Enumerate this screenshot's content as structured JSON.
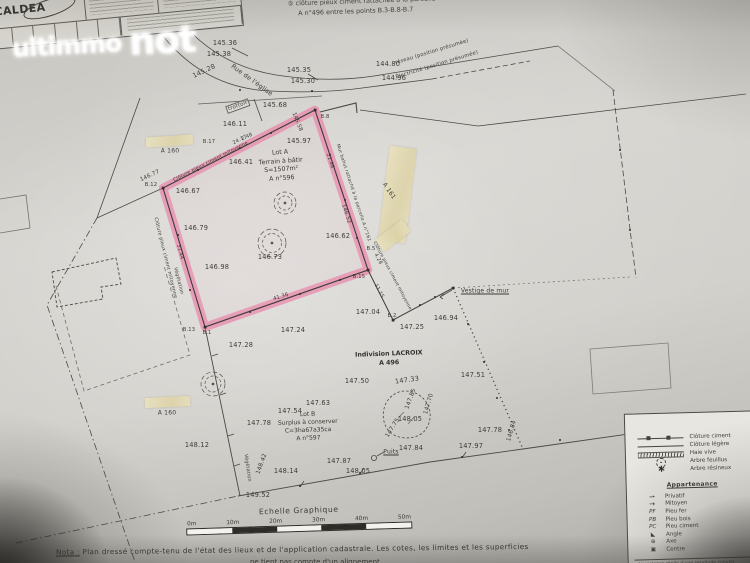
{
  "watermark": {
    "part1": "ultimmo",
    "part2": "not"
  },
  "title_block": {
    "logo": "CALDEA"
  },
  "top_note": {
    "line1": "⑤ clôture pieux ciment rattachée à la parcelle",
    "line2": "A n°496 entre les points B.3-B.8-B.7"
  },
  "lot_a": {
    "l1": "Lot A",
    "l2": "Terrain à bâtir",
    "l3": "S=1507m²",
    "l4": "A n°596"
  },
  "lot_b": {
    "l1": "Lot B",
    "l2": "Surplus à conserver",
    "l3": "C=3ha67a35ca",
    "l4": "A n°597"
  },
  "indivision": {
    "l1": "Indivision LACROIX",
    "l2": "A 496"
  },
  "scale": {
    "title": "Echelle Graphique",
    "ticks": [
      "0m",
      "10m",
      "20m",
      "30m",
      "40m",
      "50m"
    ]
  },
  "nota": {
    "prefix": "Nota :",
    "line1": "Plan dressé compte-tenu de l'état des lieux et de l'application cadastrale. Les cotes, les limites et les superficies",
    "line2": "ne tient pas compte d'un alignement"
  },
  "legend": {
    "heading": "Appartenance",
    "rows": [
      {
        "symbol": "cloture-ciment",
        "label": "Clôture ciment"
      },
      {
        "symbol": "cloture-legere",
        "label": "Clôture légère"
      },
      {
        "symbol": "haie-vive",
        "label": "Haie vive"
      },
      {
        "symbol": "arbre-feuillus",
        "label": "Arbre feuillus"
      },
      {
        "symbol": "arbre-resineux",
        "label": "Arbre résineux"
      }
    ],
    "appartenance": [
      {
        "abbr": "⇀",
        "arrow": true,
        "label": "Privatif"
      },
      {
        "abbr": "→",
        "arrow": true,
        "label": "Mitoyen"
      },
      {
        "abbr": "PF",
        "label": "Pieu fer"
      },
      {
        "abbr": "PB",
        "label": "Pieu bois"
      },
      {
        "abbr": "PC",
        "label": "Pieu ciment"
      },
      {
        "abbr": "◣",
        "label": "Angle"
      },
      {
        "abbr": "⊕",
        "label": "Axe"
      },
      {
        "abbr": "▣",
        "label": "Centre"
      }
    ],
    "footer": "L'existence réelle d'une servitude conven"
  },
  "accent_colors": {
    "highlight_pink": "#ee6b9d",
    "tape_beige": "#e3dab2",
    "line_gray": "#4b4944"
  },
  "map_labels": [
    {
      "t": "145.36",
      "x": 225,
      "y": 43
    },
    {
      "t": "145.38",
      "x": 219,
      "y": 54
    },
    {
      "t": "145.28",
      "x": 204,
      "y": 71,
      "r": -25
    },
    {
      "t": "145.35",
      "x": 299,
      "y": 70
    },
    {
      "t": "145.30",
      "x": 303,
      "y": 81
    },
    {
      "t": "144.80",
      "x": 388,
      "y": 64
    },
    {
      "t": "144.96",
      "x": 394,
      "y": 78
    },
    {
      "t": "réseau (position présumée)",
      "x": 432,
      "y": 52,
      "r": -17,
      "s": 5.2,
      "n": "utility-note"
    },
    {
      "t": "Électricité (position présumée)",
      "x": 437,
      "y": 65,
      "r": -17,
      "s": 5.2,
      "n": "utility-note"
    },
    {
      "t": "trottoir",
      "x": 238,
      "y": 106,
      "r": -20,
      "s": 5.4,
      "cls": "boxed",
      "n": "sidewalk-label"
    },
    {
      "t": "Rue de l'église",
      "x": 252,
      "y": 80,
      "r": 36,
      "s": 6.4,
      "n": "street-name"
    },
    {
      "t": "145.68",
      "x": 275,
      "y": 105
    },
    {
      "t": "145.58",
      "x": 297,
      "y": 122,
      "r": 68,
      "s": 5.4
    },
    {
      "t": "2.48",
      "x": 247,
      "y": 137,
      "r": -25,
      "s": 5
    },
    {
      "t": "B.17",
      "x": 209,
      "y": 142,
      "s": 5.2,
      "n": "boundary-point"
    },
    {
      "t": "146.11",
      "x": 235,
      "y": 124
    },
    {
      "t": "146.41",
      "x": 241,
      "y": 162
    },
    {
      "t": "145.97",
      "x": 299,
      "y": 141
    },
    {
      "t": "Clôture pieux ciment mitoyenne",
      "x": 211,
      "y": 162,
      "r": -27,
      "s": 4.8,
      "n": "fence-note"
    },
    {
      "t": "24.17",
      "x": 240,
      "y": 140,
      "r": -27,
      "s": 5,
      "n": "dimension"
    },
    {
      "t": "B.12",
      "x": 151,
      "y": 185,
      "s": 5.2,
      "n": "boundary-point"
    },
    {
      "t": "146.77",
      "x": 150,
      "y": 176,
      "r": -25,
      "s": 5.6
    },
    {
      "t": "146.67",
      "x": 188,
      "y": 191
    },
    {
      "t": "Clôture pieux ciment mitoyenne",
      "x": 165,
      "y": 258,
      "r": 76,
      "s": 4.8,
      "n": "fence-note"
    },
    {
      "t": "31.44",
      "x": 180,
      "y": 252,
      "r": 76,
      "s": 5,
      "n": "dimension"
    },
    {
      "t": "146.79",
      "x": 196,
      "y": 228
    },
    {
      "t": "146.98",
      "x": 217,
      "y": 267
    },
    {
      "t": "146.73",
      "x": 270,
      "y": 257
    },
    {
      "t": "146.62",
      "x": 338,
      "y": 236
    },
    {
      "t": "146.52",
      "x": 346,
      "y": 214,
      "r": 72,
      "s": 5.4
    },
    {
      "t": "21.48",
      "x": 330,
      "y": 161,
      "r": 72,
      "s": 5,
      "n": "dimension"
    },
    {
      "t": "Mur bahut rattaché à la parcelle A n°161",
      "x": 353,
      "y": 193,
      "r": 72,
      "s": 4.6,
      "n": "wall-note"
    },
    {
      "t": "A 161",
      "x": 389,
      "y": 191,
      "r": 56,
      "s": 6,
      "n": "parcel-label"
    },
    {
      "t": "B.8",
      "x": 325,
      "y": 117,
      "s": 5.2,
      "n": "boundary-point"
    },
    {
      "t": "B.5",
      "x": 371,
      "y": 249,
      "s": 5.2,
      "n": "boundary-point"
    },
    {
      "t": "4.28",
      "x": 378,
      "y": 259,
      "r": 62,
      "s": 5,
      "n": "dimension"
    },
    {
      "t": "B.15",
      "x": 359,
      "y": 277,
      "s": 5.2,
      "n": "boundary-point"
    },
    {
      "t": "11.15",
      "x": 379,
      "y": 291,
      "r": 62,
      "s": 5,
      "n": "dimension"
    },
    {
      "t": "Clôture pieux ciment mitoyenne",
      "x": 392,
      "y": 276,
      "r": 62,
      "s": 4.4,
      "n": "fence-note"
    },
    {
      "t": "B.2",
      "x": 392,
      "y": 316,
      "s": 5.2,
      "n": "boundary-point"
    },
    {
      "t": "41.36",
      "x": 281,
      "y": 297,
      "r": -17,
      "s": 5.2,
      "n": "dimension"
    },
    {
      "t": "B.13",
      "x": 189,
      "y": 330,
      "s": 5.2,
      "n": "boundary-point"
    },
    {
      "t": "B.1",
      "x": 207,
      "y": 333,
      "s": 5.2,
      "n": "boundary-point"
    },
    {
      "t": "Végétation",
      "x": 178,
      "y": 281,
      "r": 76,
      "s": 4.8,
      "n": "vegetation-note"
    },
    {
      "t": "147.28",
      "x": 241,
      "y": 345
    },
    {
      "t": "147.24",
      "x": 293,
      "y": 330
    },
    {
      "t": "147.04",
      "x": 368,
      "y": 312
    },
    {
      "t": "147.25",
      "x": 412,
      "y": 327
    },
    {
      "t": "146.94",
      "x": 446,
      "y": 318
    },
    {
      "t": "Vestige de mur",
      "x": 485,
      "y": 291,
      "s": 6,
      "cls": "underline",
      "n": "feature-label"
    },
    {
      "t": "147.50",
      "x": 357,
      "y": 381
    },
    {
      "t": "147.33",
      "x": 407,
      "y": 380,
      "r": -8
    },
    {
      "t": "147.51",
      "x": 473,
      "y": 375
    },
    {
      "t": "147.63",
      "x": 318,
      "y": 403
    },
    {
      "t": "147.54",
      "x": 290,
      "y": 411
    },
    {
      "t": "147.78",
      "x": 259,
      "y": 423
    },
    {
      "t": "147.85",
      "x": 411,
      "y": 399,
      "r": -70,
      "s": 5.8
    },
    {
      "t": "147.70",
      "x": 429,
      "y": 404,
      "r": -74,
      "s": 5.8
    },
    {
      "t": "148.05",
      "x": 410,
      "y": 419
    },
    {
      "t": "147.75",
      "x": 393,
      "y": 428,
      "r": -58,
      "s": 5.8
    },
    {
      "t": "147.78",
      "x": 490,
      "y": 430
    },
    {
      "t": "146.84",
      "x": 512,
      "y": 431,
      "r": -74,
      "s": 5.8
    },
    {
      "t": "148.12",
      "x": 197,
      "y": 445
    },
    {
      "t": "148.42",
      "x": 262,
      "y": 464,
      "r": -70,
      "s": 5.8
    },
    {
      "t": "Végétation",
      "x": 247,
      "y": 468,
      "r": 82,
      "s": 4.8,
      "n": "vegetation-note"
    },
    {
      "t": "148.14",
      "x": 286,
      "y": 471
    },
    {
      "t": "147.87",
      "x": 339,
      "y": 461
    },
    {
      "t": "148.05",
      "x": 358,
      "y": 471
    },
    {
      "t": "Puits",
      "x": 391,
      "y": 452,
      "s": 6,
      "cls": "underline",
      "n": "well-label"
    },
    {
      "t": "147.84",
      "x": 411,
      "y": 448
    },
    {
      "t": "147.97",
      "x": 471,
      "y": 446
    },
    {
      "t": "149.52",
      "x": 258,
      "y": 495
    },
    {
      "t": "A 160",
      "x": 170,
      "y": 151,
      "s": 6,
      "n": "parcel-label"
    },
    {
      "t": "A 160",
      "x": 167,
      "y": 413,
      "s": 6,
      "n": "parcel-label"
    }
  ]
}
